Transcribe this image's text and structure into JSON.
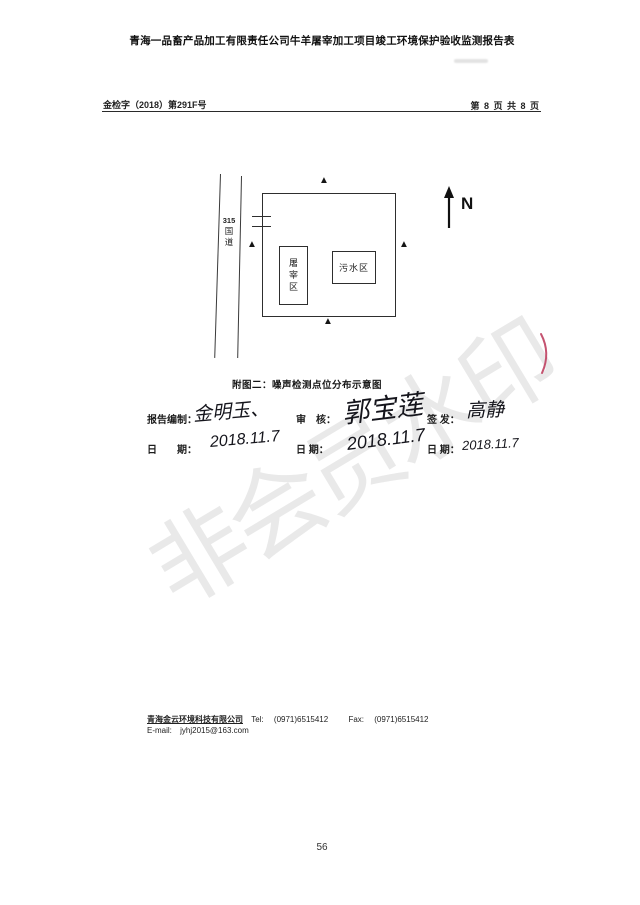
{
  "document": {
    "title": "青海一品畜产品加工有限责任公司牛羊屠宰加工项目竣工环境保护验收监测报告表",
    "doc_number": "金检字（2018）第291F号",
    "page_indicator": "第 8 页 共 8 页",
    "page_number": "56",
    "watermark": "非会员水印"
  },
  "diagram": {
    "caption": "附图二：噪声检测点位分布示意图",
    "road": {
      "number": "315",
      "name_char1": "国",
      "name_char2": "道"
    },
    "slaughter_area": "屠宰区",
    "sewage_area": "污水区",
    "marker": "▲",
    "north_label": "N"
  },
  "signoff": {
    "prepared_label": "报告编制：",
    "prepared_signature": "金明玉、",
    "prepared_date": "2018.11.7",
    "review_label": "审　核：",
    "review_signature": "郭宝莲",
    "review_date": "2018.11.7",
    "issue_label": "签 发：",
    "issue_signature": "高静",
    "issue_date": "2018.11.7",
    "date_label_wide": "日　　期：",
    "date_label_mid": "日 期：",
    "date_label_right": "日 期："
  },
  "footer": {
    "company": "青海金云环境科技有限公司",
    "tel_label": "Tel:",
    "tel_value": "(0971)6515412",
    "fax_label": "Fax:",
    "fax_value": "(0971)6515412",
    "email_label": "E-mail:",
    "email_value": "jyhj2015@163.com"
  },
  "colors": {
    "ink": "#1d1d1d",
    "pen_mark": "#bf4060",
    "watermark_gray": "#e9e9e9"
  }
}
